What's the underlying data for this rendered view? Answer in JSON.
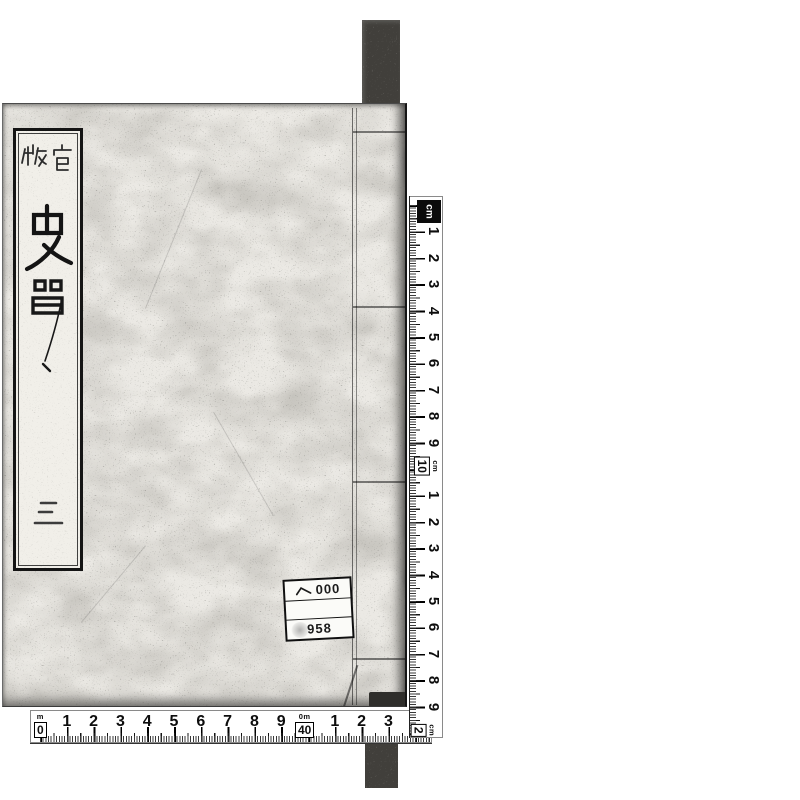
{
  "scene": {
    "background": "#ffffff",
    "description": "Photographic scan of a traditionally bound Japanese book cover with measuring scales along the right and bottom edges"
  },
  "book": {
    "cover_color": "#ebe9e4",
    "title_slip": {
      "imprint": "官版",
      "title_chars": [
        "史",
        "記"
      ],
      "volume_label": "三"
    },
    "call_number_label": {
      "row1_symbol": "ヘ",
      "row1_number": "000",
      "row2": "",
      "row3_number": "958"
    }
  },
  "rulers": {
    "right": {
      "unit": "cm",
      "start_logo_label": "cm",
      "numbers_first": [
        "1",
        "2",
        "3",
        "4",
        "5",
        "6",
        "7",
        "8",
        "9"
      ],
      "decimeter_mark": {
        "sub": "cm",
        "main": "10"
      },
      "numbers_second": [
        "1",
        "2",
        "3",
        "4",
        "5",
        "6",
        "7",
        "8",
        "9"
      ],
      "end_mark": {
        "sub": "cm",
        "main": "2"
      }
    },
    "bottom": {
      "unit": "cm",
      "start_mark": {
        "sub": "m",
        "main": "0"
      },
      "numbers_first": [
        "1",
        "2",
        "3",
        "4",
        "5",
        "6",
        "7",
        "8",
        "9"
      ],
      "decimeter_mark": {
        "sub": "0m",
        "main": "40"
      },
      "numbers_second": [
        "1",
        "2",
        "3"
      ]
    }
  },
  "colors": {
    "strip": "#413f3b",
    "ink": "#111111",
    "cover": "#ebe9e4",
    "label_bg": "#fbfbf8"
  }
}
